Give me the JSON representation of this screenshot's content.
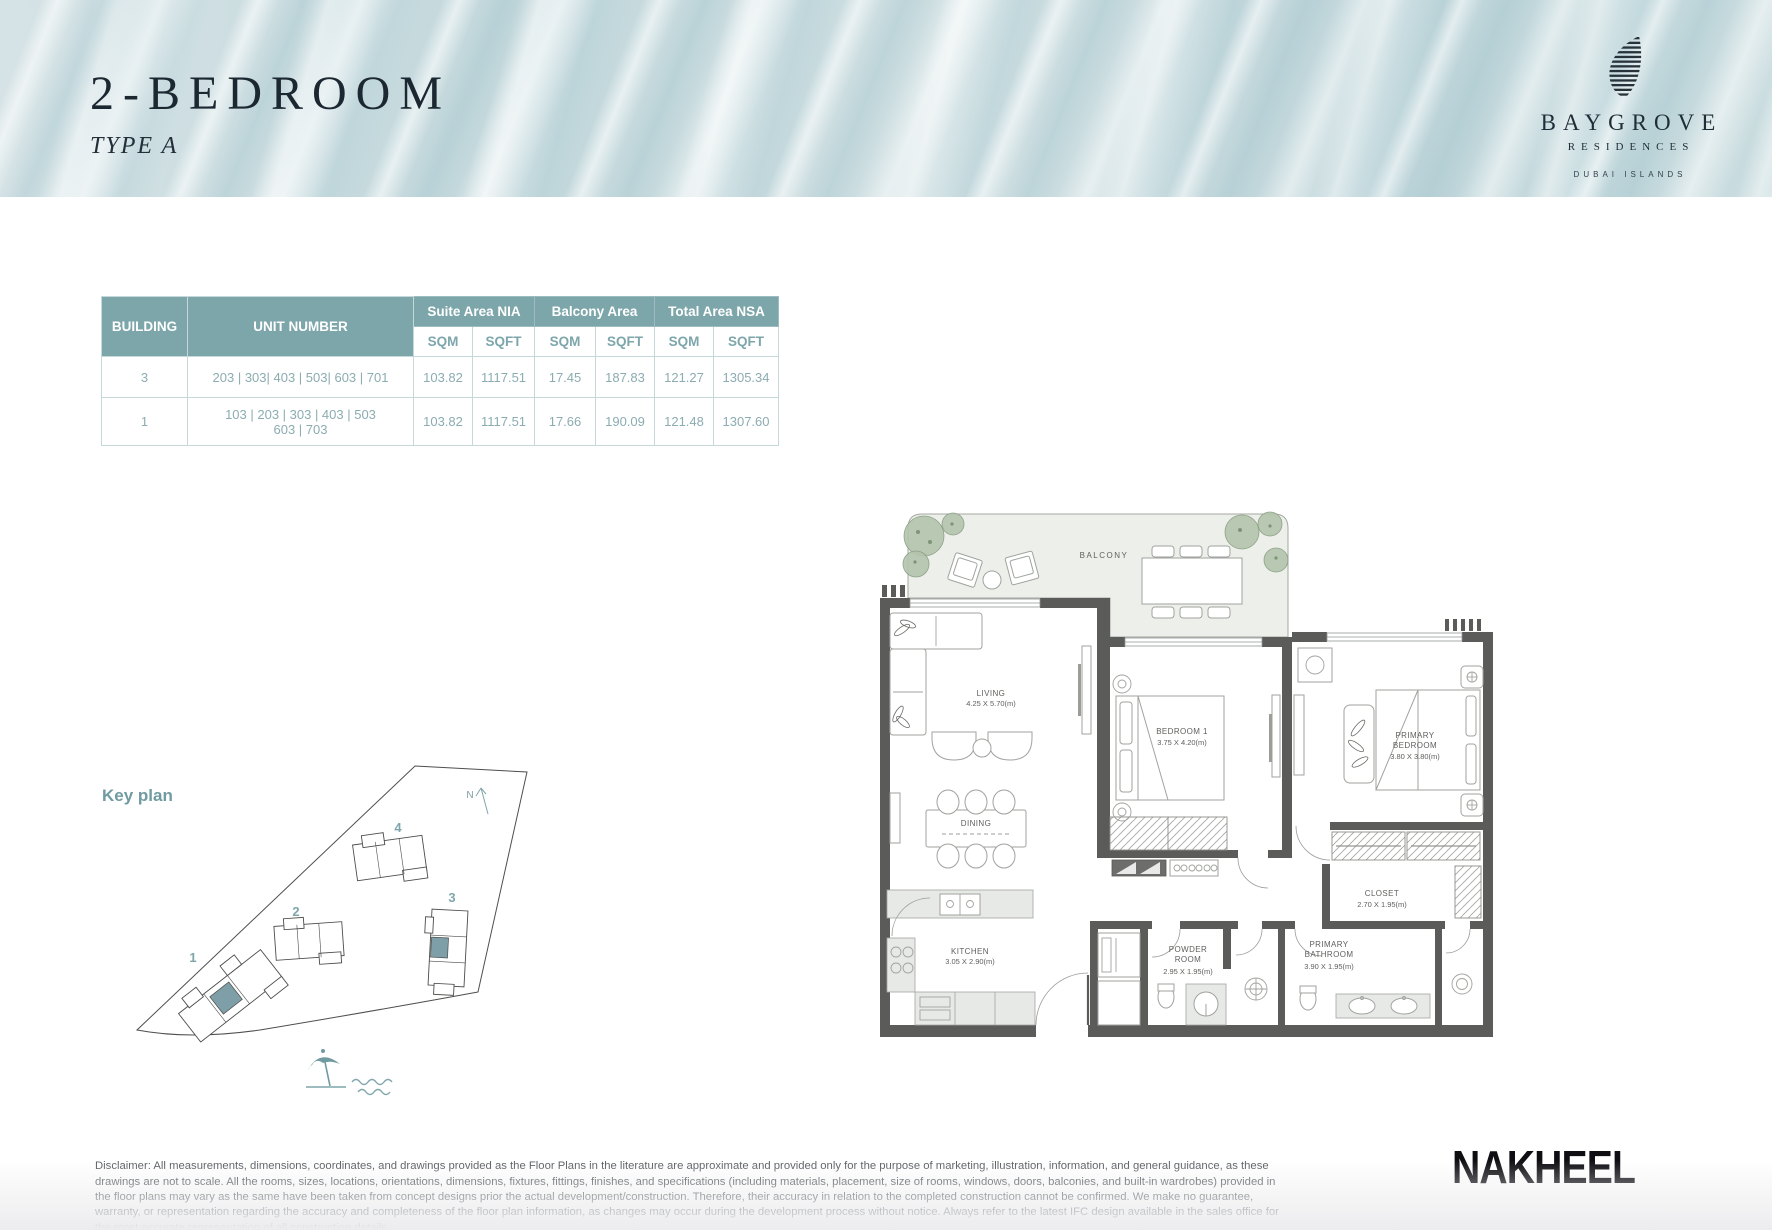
{
  "header": {
    "title": "2-BEDROOM",
    "subtitle": "TYPE A",
    "brand": {
      "name": "BAYGROVE",
      "sub": "RESIDENCES",
      "location": "DUBAI ISLANDS"
    }
  },
  "table": {
    "col_building": "BUILDING",
    "col_unit": "UNIT NUMBER",
    "group_suite": "Suite Area NIA",
    "group_balcony": "Balcony Area",
    "group_total": "Total Area NSA",
    "sqm": "SQM",
    "sqft": "SQFT",
    "rows": [
      {
        "building": "3",
        "units_line1": "203 | 303| 403 | 503| 603 | 701",
        "units_line2": "",
        "suite_sqm": "103.82",
        "suite_sqft": "1117.51",
        "balcony_sqm": "17.45",
        "balcony_sqft": "187.83",
        "total_sqm": "121.27",
        "total_sqft": "1305.34"
      },
      {
        "building": "1",
        "units_line1": "103 | 203 | 303 | 403 | 503",
        "units_line2": "603 | 703",
        "suite_sqm": "103.82",
        "suite_sqft": "1117.51",
        "balcony_sqm": "17.66",
        "balcony_sqft": "190.09",
        "total_sqm": "121.48",
        "total_sqft": "1307.60"
      }
    ]
  },
  "keyplan": {
    "label": "Key plan",
    "north": "N",
    "buildings": [
      "1",
      "2",
      "3",
      "4"
    ]
  },
  "floorplan": {
    "balcony": "BALCONY",
    "living": {
      "name": "LIVING",
      "dims": "4.25 X 5.70(m)"
    },
    "dining": {
      "name": "DINING"
    },
    "kitchen": {
      "name": "KITCHEN",
      "dims": "3.05 X 2.90(m)"
    },
    "bedroom1": {
      "name": "BEDROOM 1",
      "dims": "3.75 X 4.20(m)"
    },
    "primary_bedroom": {
      "line1": "PRIMARY",
      "line2": "BEDROOM",
      "dims": "3.80 X 3.80(m)"
    },
    "powder": {
      "line1": "POWDER",
      "line2": "ROOM",
      "dims": "2.95 X 1.95(m)"
    },
    "primary_bath": {
      "line1": "PRIMARY",
      "line2": "BATHROOM",
      "dims": "3.90 X 1.95(m)"
    },
    "closet": {
      "name": "CLOSET",
      "dims": "2.70 X 1.95(m)"
    }
  },
  "footer": {
    "disclaimer": "Disclaimer: All measurements, dimensions, coordinates, and drawings provided as the Floor Plans in the literature are approximate and provided only for the purpose of marketing, illustration, information, and general guidance, as these drawings are not to scale. All the rooms, sizes, locations, orientations, dimensions, fixtures, fittings, finishes, and specifications (including materials, placement, size of rooms, windows, doors, balconies, and built-in wardrobes) provided in the floor plans may vary as the same have been taken from concept designs prior the actual development/construction. Therefore, their accuracy in relation to the completed construction cannot be confirmed. We make no guarantee, warranty, or representation regarding the accuracy and completeness of the floor plan information, as changes may occur during the development process without notice. Always refer to the latest IFC design available in the sales office for the most accurate representation of all construction details.",
    "logo": "NAKHEEL"
  }
}
